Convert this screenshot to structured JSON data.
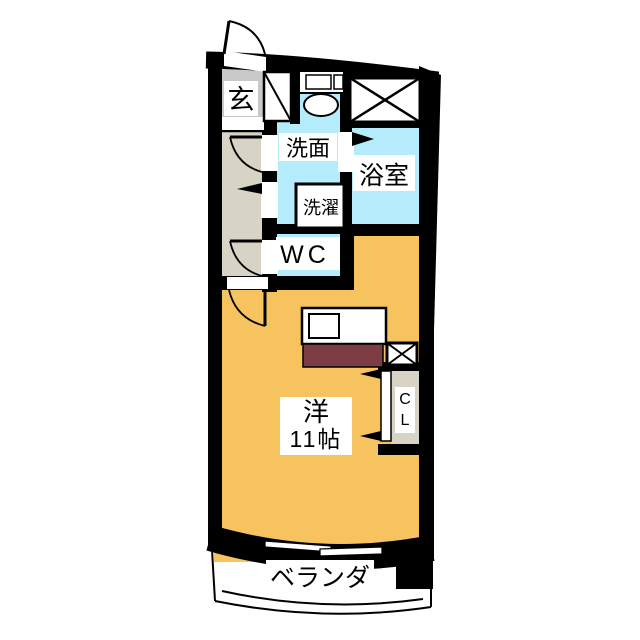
{
  "plan": {
    "type": "apartment-floorplan",
    "rooms": {
      "entrance": {
        "label": "玄"
      },
      "washroom": {
        "label": "洗面"
      },
      "bathroom": {
        "label": "浴室"
      },
      "laundry": {
        "label": "洗濯"
      },
      "toilet": {
        "label": "WC"
      },
      "living": {
        "label_line1": "洋",
        "label_line2": "11帖"
      },
      "closet": {
        "letter1": "C",
        "letter2": "L"
      },
      "veranda": {
        "label": "ベランダ"
      }
    },
    "colors": {
      "wall": "#000000",
      "living_floor": "#F6C35F",
      "water_floor": "#B4ECFB",
      "entrance_floor": "#C9C9C9",
      "hallway_floor": "#D7D3C5",
      "kitchen_counter": "#7C3E44",
      "background": "#FFFFFF"
    }
  }
}
